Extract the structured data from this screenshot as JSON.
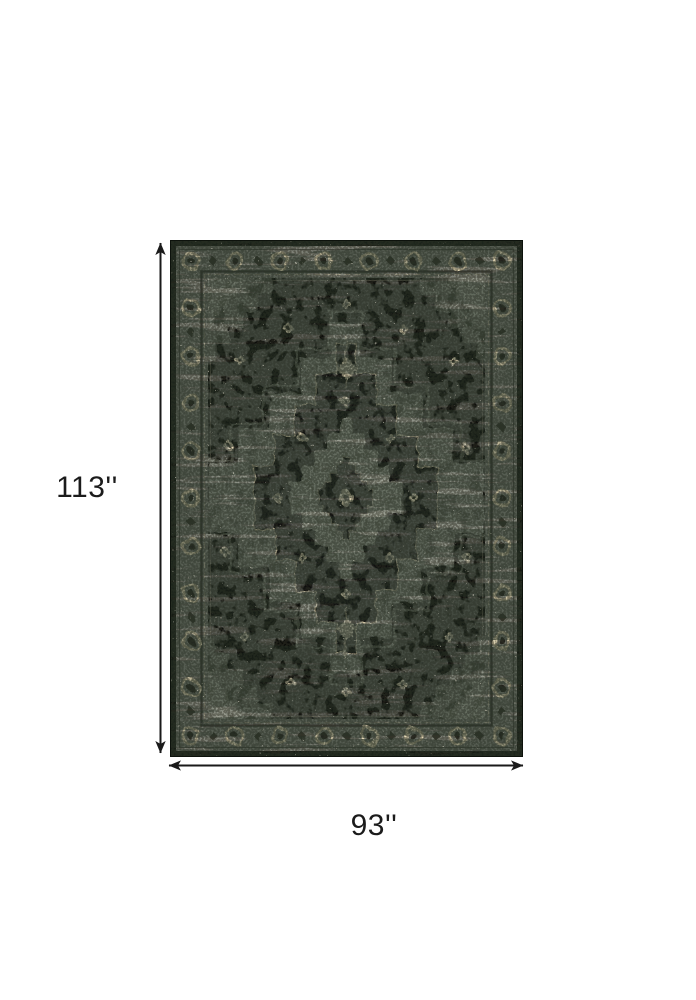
{
  "page": {
    "background": "#ffffff"
  },
  "diagram": {
    "height_label": "113''",
    "width_label": "93''",
    "arrow_color": "#1a1a1a",
    "label_color": "#1b1b1b"
  },
  "rug": {
    "description": "distressed oriental medallion area rug, black field with gray floral border",
    "colors": {
      "outer_edge": "#161c14",
      "border_band": "#7e8177",
      "band_light": "#a8aaa0",
      "field": "#0c0d0a",
      "medallion_black": "#0d0e0a",
      "medallion_gray": "#868a7e",
      "ornament_gray": "#6e7267",
      "corner_gray": "#51544b",
      "accent_cream": "#e6d9b8",
      "guard_dark": "#3f423a"
    }
  }
}
